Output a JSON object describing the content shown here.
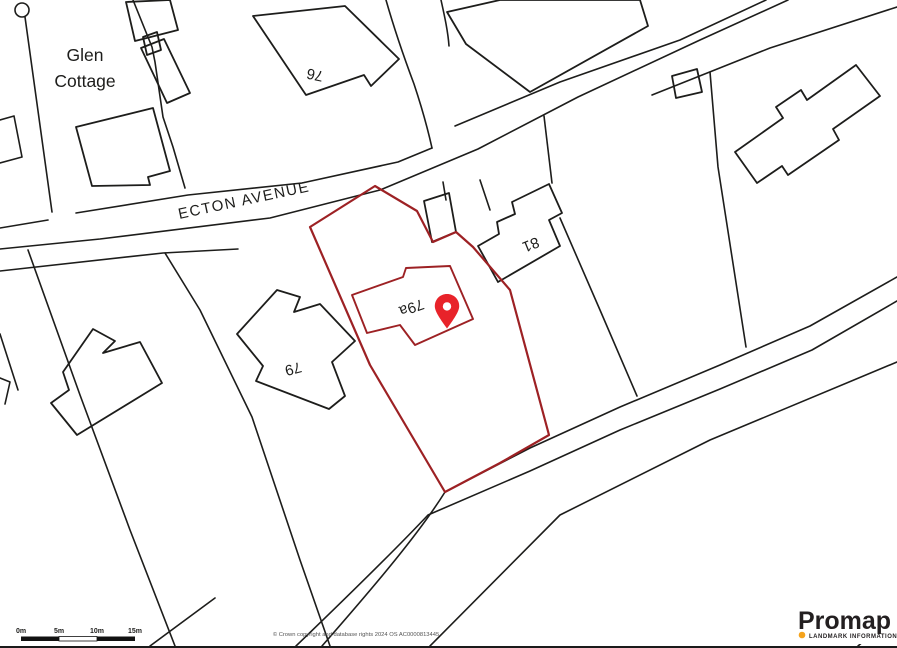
{
  "map": {
    "labels": {
      "glen_cottage_line1": "Glen",
      "glen_cottage_line2": "Cottage",
      "street": "ECTON AVENUE",
      "plot_number": "79a",
      "house_76": "76",
      "house_79": "79",
      "house_81": "81"
    },
    "marker": {
      "name": "location-pin",
      "color": "#e8232a"
    },
    "plot_outline_color": "#9d2124",
    "line_color": "#1d1d1b"
  },
  "scale_bar": {
    "labels": [
      "0m",
      "5m",
      "10m",
      "15m"
    ]
  },
  "footer": {
    "copyright": "© Crown copyright and database rights 2024 OS AC0000813445"
  },
  "logo": {
    "name": "Promap",
    "tagline": "LANDMARK INFORMATION",
    "dot_color": "#f5a31c",
    "text_color": "#231f20"
  }
}
